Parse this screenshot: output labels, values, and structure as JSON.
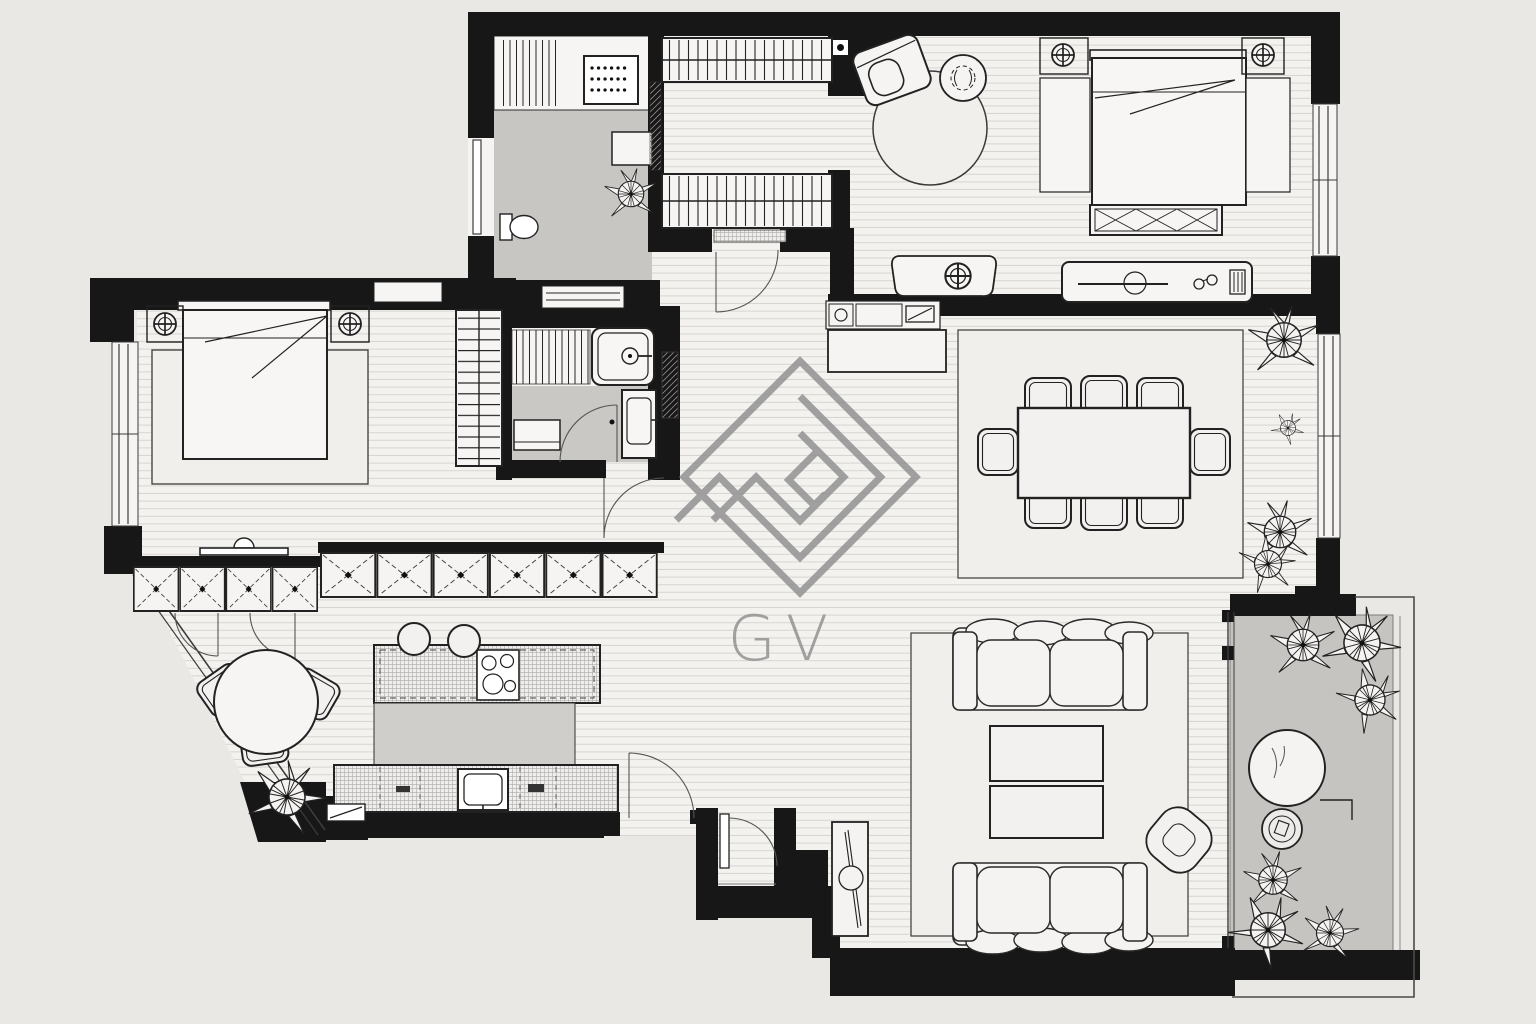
{
  "watermark": {
    "text": "GV",
    "symbol": "diamond-spiral-monogram"
  },
  "palette": {
    "paper": "#e9e8e5",
    "floor": "#f3f2ef",
    "plank_line": "#d8d5d1",
    "gray_floor": "#c7c6c3",
    "wall_black": "#171717",
    "ink": "#2a2a2a",
    "rug": "#f0efec",
    "watermark_gray": "#8f8f8f"
  },
  "plan": {
    "rooms": [
      "laundry-room",
      "dressing-room",
      "bedroom",
      "master-bedroom",
      "bathroom",
      "hallway",
      "dining-area",
      "kitchen",
      "breakfast-nook",
      "living-room",
      "terrace",
      "entry-vestibule"
    ],
    "counts": {
      "dining_chairs": 8,
      "dining_tables": 1,
      "sofas": 2,
      "coffee_tables": 2,
      "poufs": 1,
      "beds": 2,
      "bedside_lamps": 4,
      "wardrobe_runs": 2,
      "sideboard_doors": 10,
      "bar_stools": 2,
      "breakfast_chairs": 3,
      "terrace_plants": 6,
      "indoor_plants": 4,
      "bathtubs": 1,
      "showers": 1,
      "toilets": 1,
      "washing_machines": 1
    }
  }
}
